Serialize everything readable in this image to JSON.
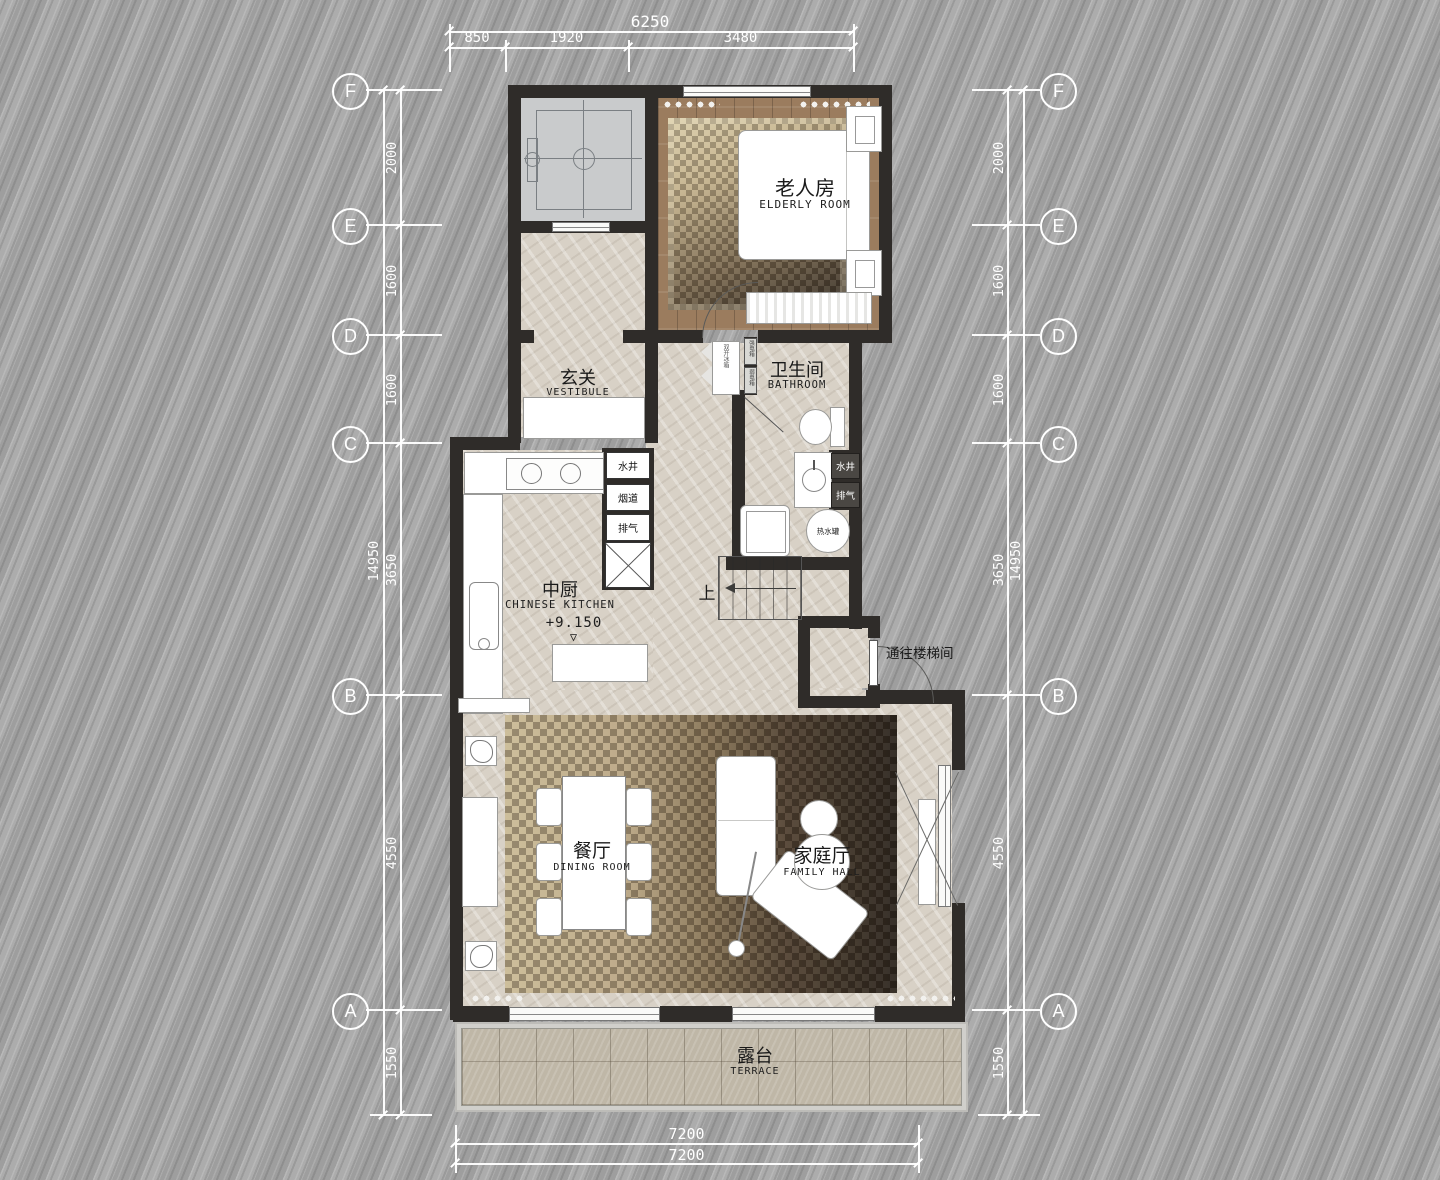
{
  "colors": {
    "wall": "#2f2c29",
    "marble_floor": "#d8d1c6",
    "wood_floor": "#9b7c5e",
    "background": "#a8a8a8",
    "dimension_text": "#ffffff",
    "label_text": "#191919"
  },
  "grid": {
    "row_labels": [
      "F",
      "E",
      "D",
      "C",
      "B",
      "A"
    ],
    "segment_dims": [
      "2000",
      "1600",
      "1600",
      "3650",
      "4550",
      "1550"
    ],
    "overall_dim": "14950"
  },
  "dims_top": {
    "total": "6250",
    "segments": [
      "850",
      "1920",
      "3480"
    ]
  },
  "dims_bottom": {
    "values": [
      "7200",
      "7200"
    ]
  },
  "rooms": {
    "elderly": {
      "zh": "老人房",
      "en": "ELDERLY ROOM"
    },
    "vestibule": {
      "zh": "玄关",
      "en": "VESTIBULE"
    },
    "bathroom": {
      "zh": "卫生间",
      "en": "BATHROOM"
    },
    "kitchen": {
      "zh": "中厨",
      "en": "CHINESE KITCHEN",
      "level": "+9.150"
    },
    "dining": {
      "zh": "餐厅",
      "en": "DINING ROOM"
    },
    "family": {
      "zh": "家庭厅",
      "en": "FAMILY HALL"
    },
    "terrace": {
      "zh": "露台",
      "en": "TERRACE"
    }
  },
  "annotations": {
    "water_well_kitchen": "水井",
    "flue": "烟道",
    "exhaust_kitchen": "排气",
    "water_well_bath": "水井",
    "exhaust_bath": "排气",
    "hot_water_tank": "热水罐",
    "up": "上",
    "to_stairwell": "通往楼梯间",
    "strong_elec_box": "强电箱",
    "weak_elec_box": "弱电箱",
    "fridge": "双开冰箱"
  },
  "icons": {
    "level_triangle": "▽"
  }
}
